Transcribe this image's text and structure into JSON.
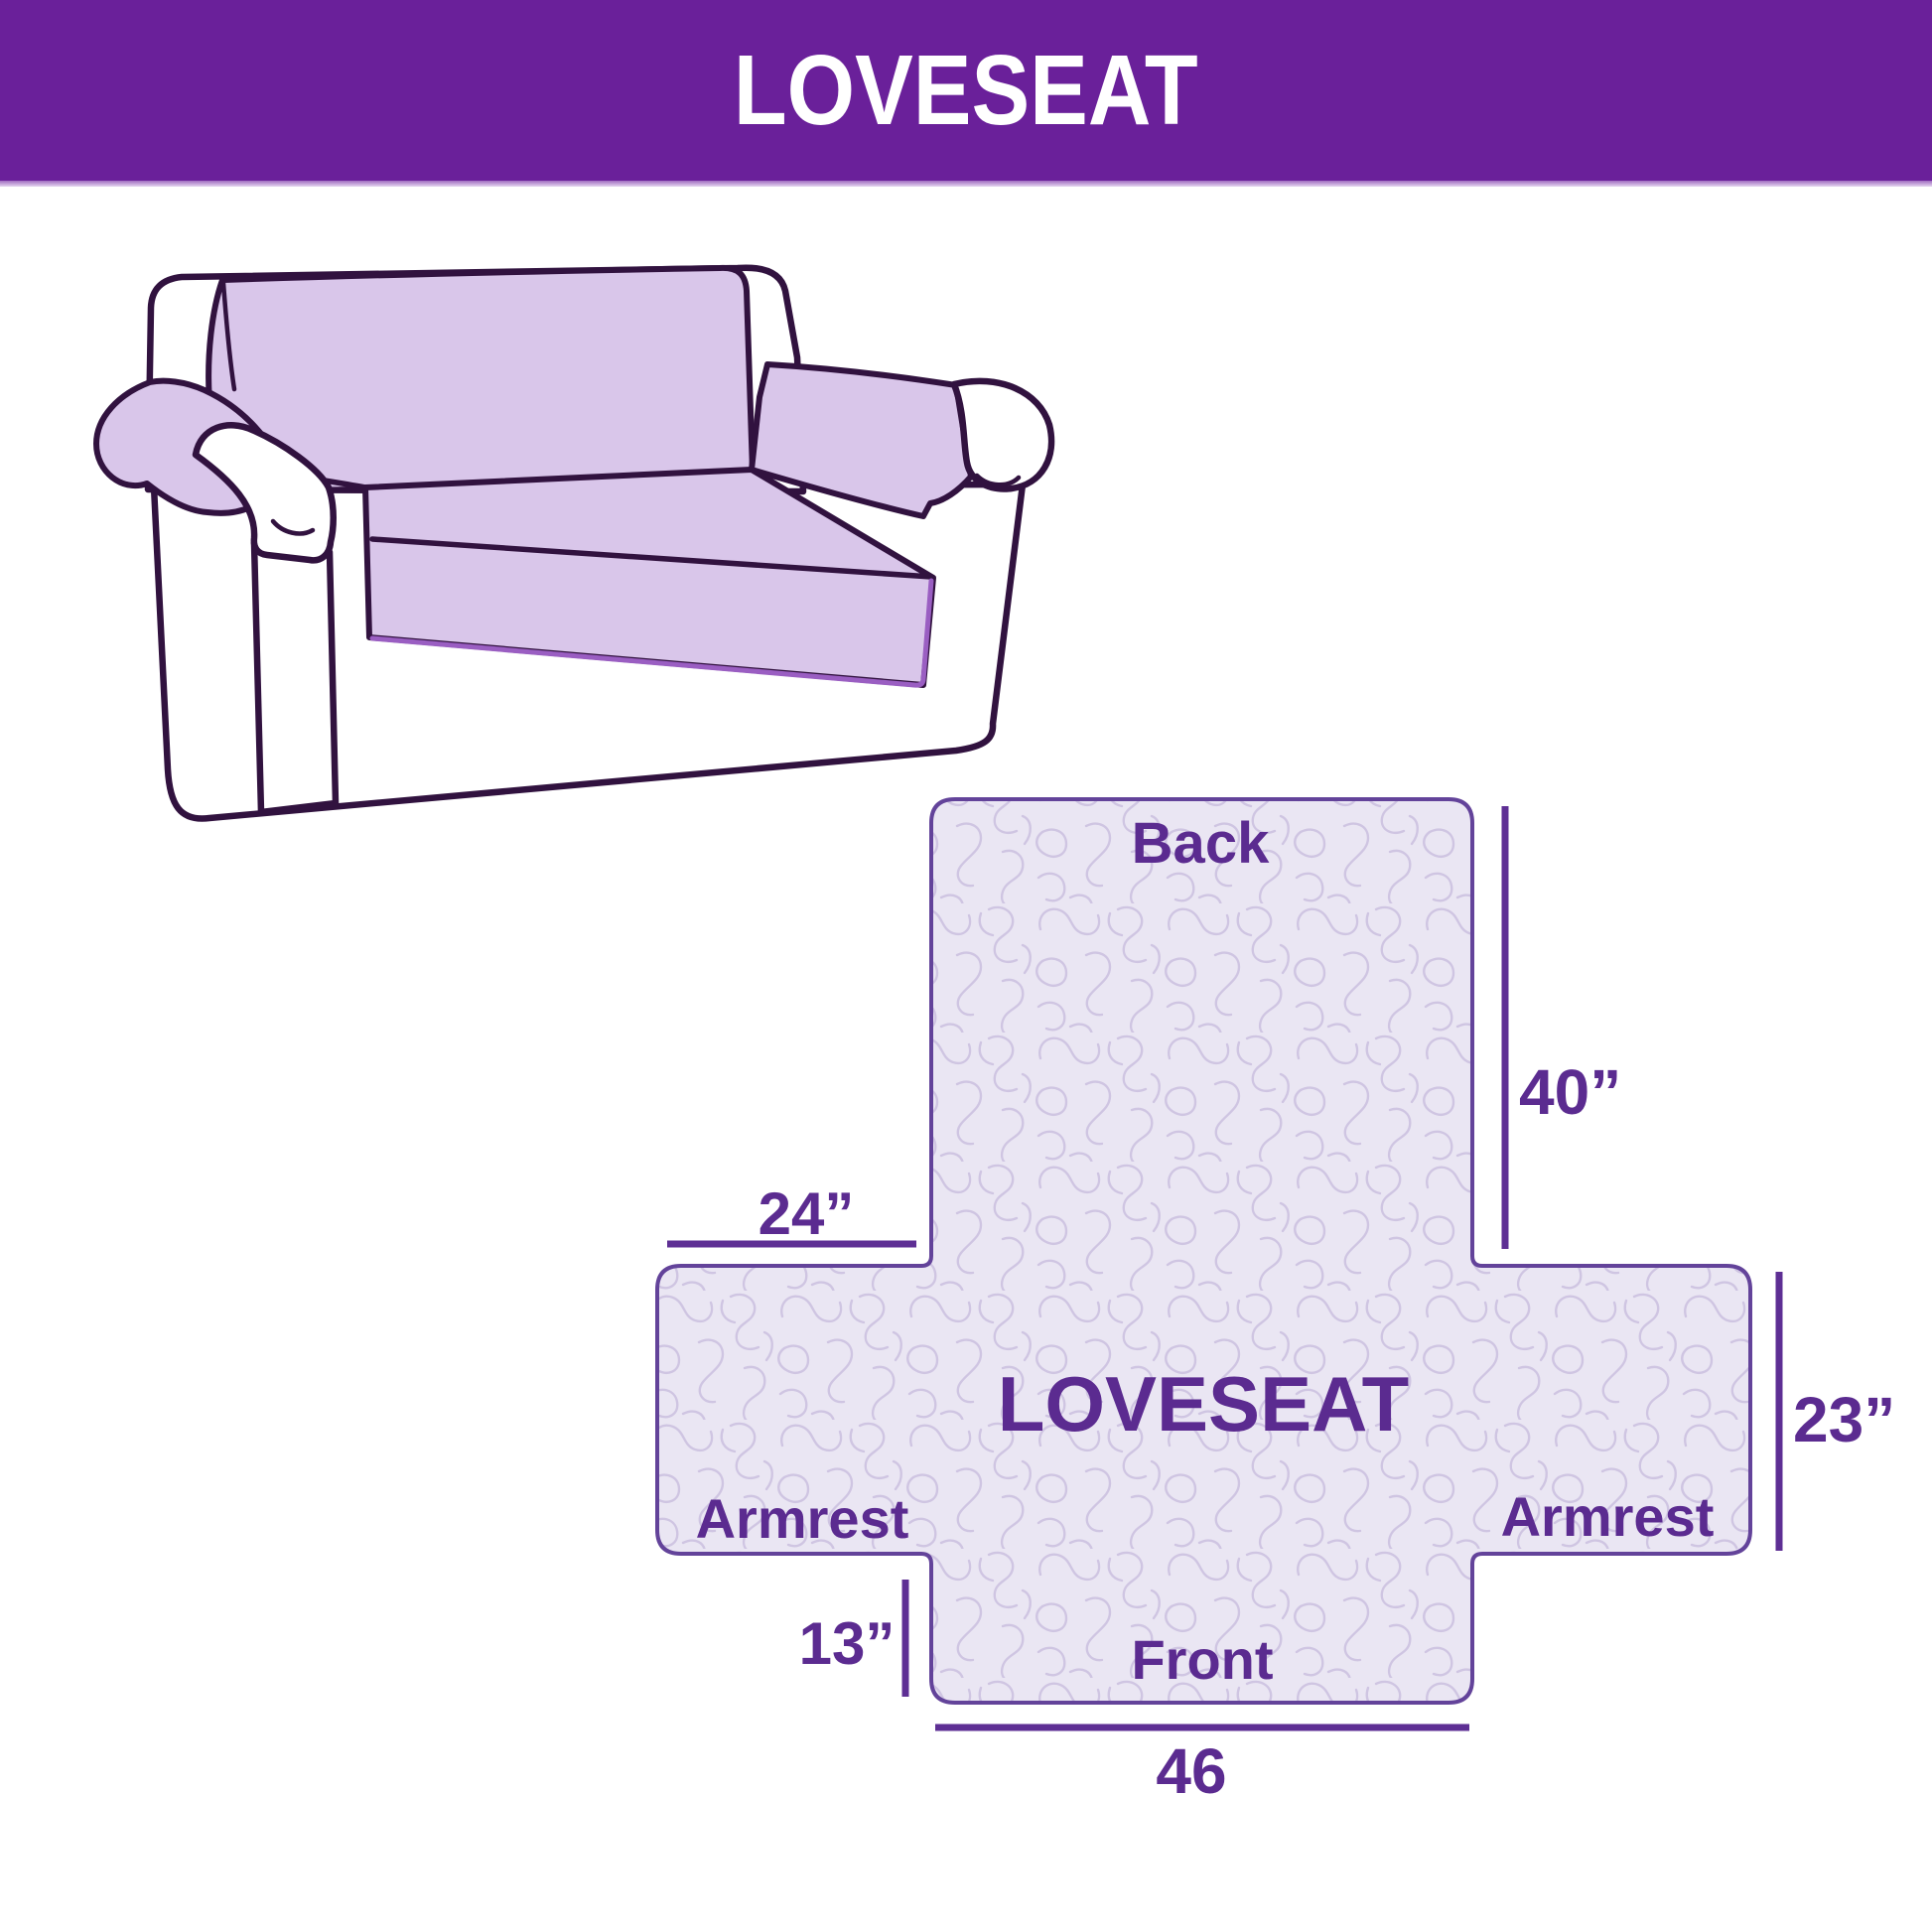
{
  "header": {
    "title": "LOVESEAT"
  },
  "colors": {
    "background": "#ffffff",
    "banner": "#6a209a",
    "banner_text": "#ffffff",
    "label": "#5b2b90",
    "dimension": "#5e2f94",
    "shape_fill": "#eae6f3",
    "shape_line": "#63439a",
    "texture": "#cfc5e2",
    "cover_fill": "#d9c6ea",
    "cover_hem": "#9a5ec2",
    "sofa_line": "#31123f"
  },
  "illustration": {
    "description": "loveseat with slipcover"
  },
  "diagram": {
    "center_label": "LOVESEAT",
    "sections": {
      "back": "Back",
      "front": "Front",
      "armrest_left": "Armrest",
      "armrest_right": "Armrest"
    },
    "dimensions": {
      "back_height": "40”",
      "armrest_width": "24”",
      "armrest_height": "23”",
      "front_drop": "13”",
      "front_width": "46"
    }
  }
}
